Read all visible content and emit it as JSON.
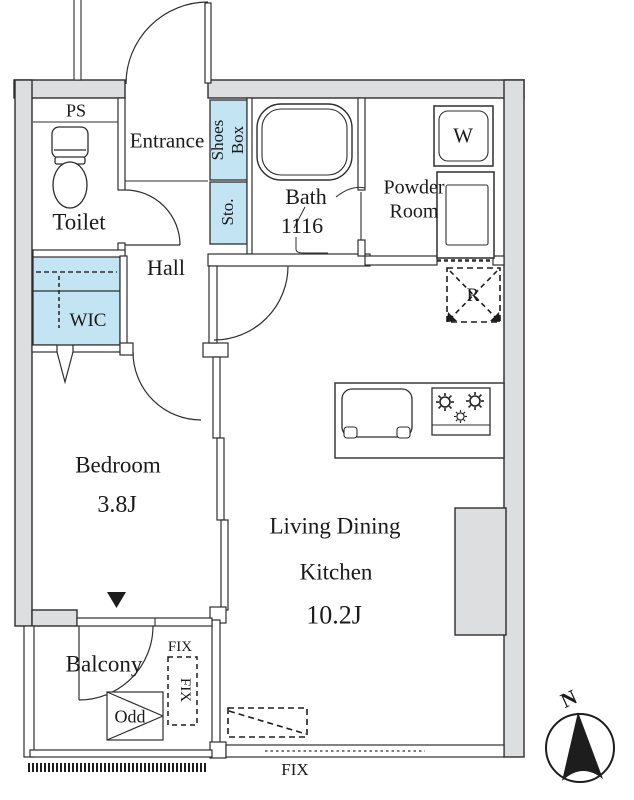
{
  "labels": {
    "ps": "PS",
    "toilet": "Toilet",
    "entrance": "Entrance",
    "shoes_box": {
      "line1": "Shoes",
      "line2": "Box"
    },
    "storage": "Sto.",
    "bath": {
      "name": "Bath",
      "size": "1116"
    },
    "powder_room": {
      "line1": "Powder",
      "line2": "Room"
    },
    "washer": "W",
    "hall": "Hall",
    "wic": "WIC",
    "refrigerator": "R",
    "bedroom": {
      "name": "Bedroom",
      "size": "3.8J"
    },
    "ldk": {
      "line1": "Living Dining",
      "line2": "Kitchen",
      "size": "10.2J"
    },
    "balcony": "Balcony",
    "odd": "Odd",
    "fix_window_top": "FIX",
    "fix_window_side": "FIX",
    "fix_window_bottom": "FIX",
    "compass_north": "N"
  },
  "colors": {
    "wall_fill": "#dcdee0",
    "closet_fill": "#c3e4f3",
    "line": "#2e2e2e",
    "text": "#1a1a1a"
  }
}
